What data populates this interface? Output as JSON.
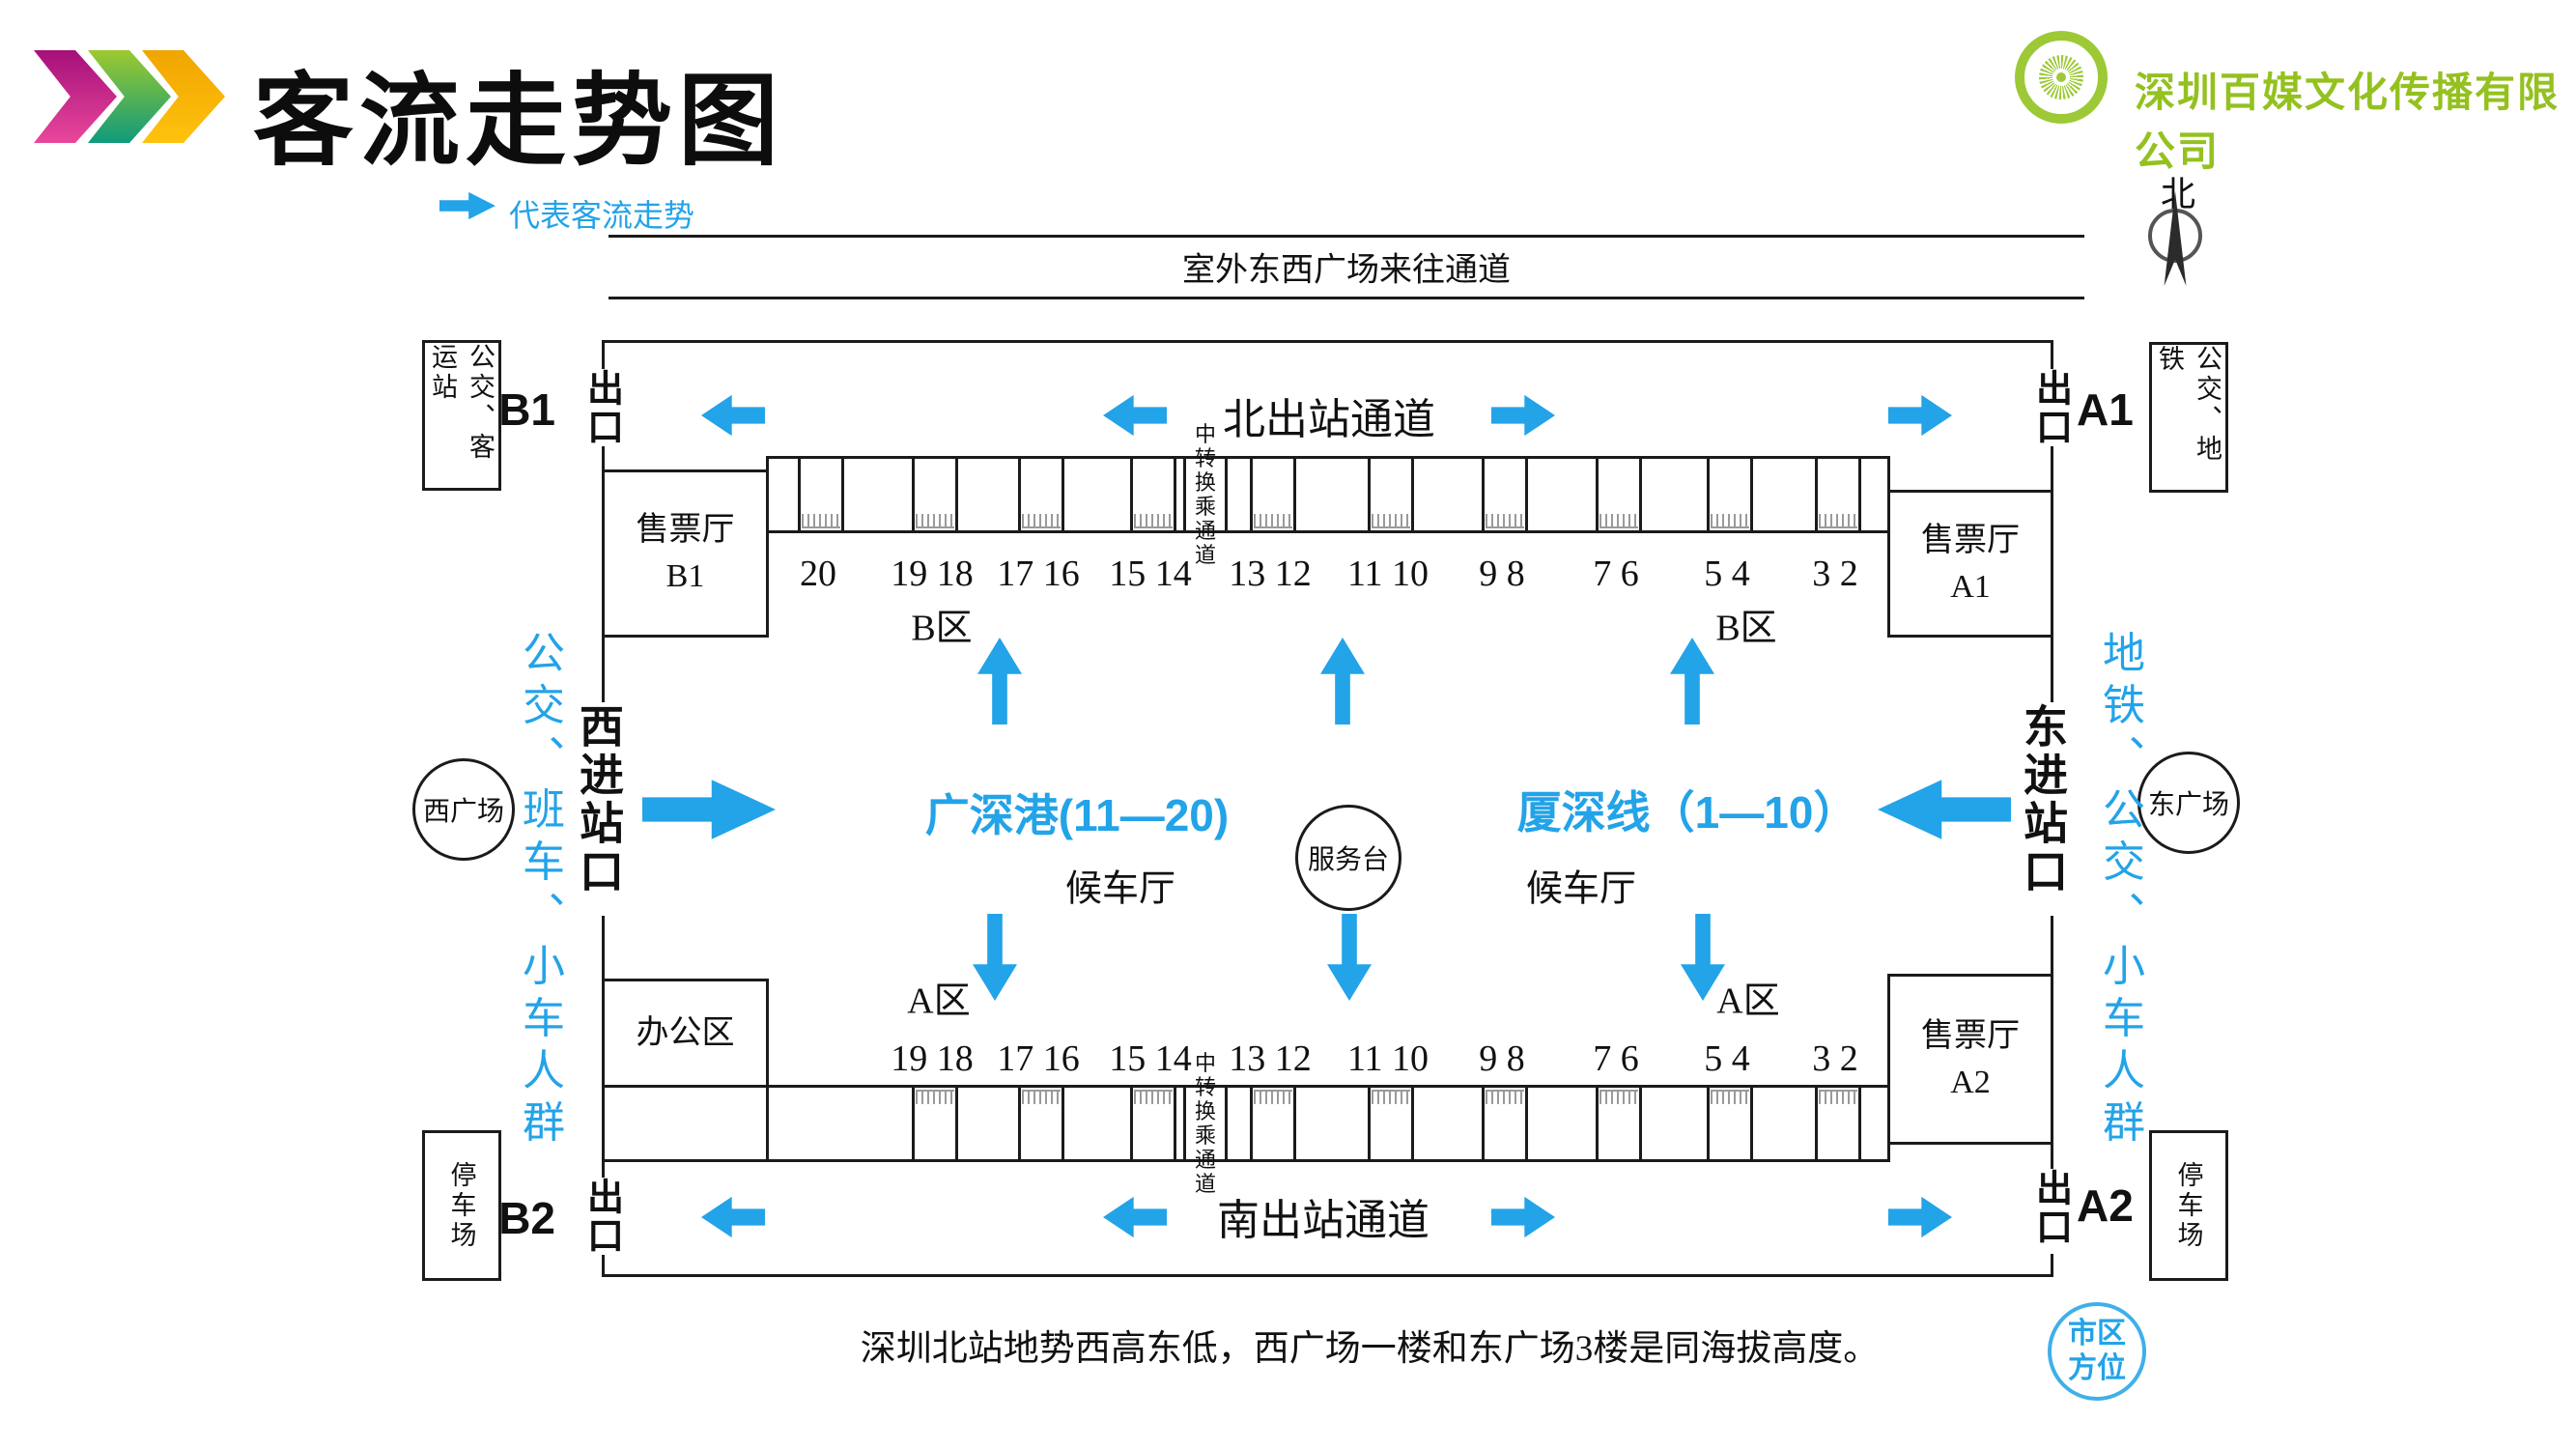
{
  "header": {
    "title": "客流走势图",
    "company": "深圳百媒文化传播有限公司"
  },
  "legend": {
    "label": "代表客流走势"
  },
  "compass": {
    "label": "北"
  },
  "corridors": {
    "outside": "室外东西广场来往通道",
    "north": "北出站通道",
    "south": "南出站通道"
  },
  "exits": {
    "exit_word": "出口",
    "b1": "B1",
    "a1": "A1",
    "b2": "B2",
    "a2": "A2"
  },
  "gates": {
    "west": "西进站口",
    "east": "东进站口"
  },
  "flow_labels": {
    "west": "公交、班车、小车人群",
    "east": "地铁、公交、小车人群"
  },
  "side_boxes": {
    "top_left": "公交、客运站",
    "top_right": "公交、地铁",
    "bottom_left": "停车场",
    "bottom_right": "停车场"
  },
  "plazas": {
    "west": "西广场",
    "east": "东广场"
  },
  "city_badge": {
    "line1": "市区",
    "line2": "方位"
  },
  "rooms": {
    "ticket_hall": "售票厅",
    "ticket_b1": "B1",
    "ticket_a1": "A1",
    "ticket_a2": "A2",
    "office": "办公区"
  },
  "hall": {
    "service_desk": "服务台",
    "west_line": "广深港(11—20)",
    "east_line": "厦深线（1—10）",
    "waiting_hall": "候车厅",
    "zone_b": "B区",
    "zone_a": "A区",
    "transfer": "中转换乘通道"
  },
  "platforms": {
    "top": [
      "20",
      "19 18",
      "17 16",
      "15 14",
      "13 12",
      "11 10",
      "9 8",
      "7 6",
      "5 4",
      "3 2"
    ],
    "bottom": [
      "19 18",
      "17 16",
      "15 14",
      "13 12",
      "11 10",
      "9 8",
      "7 6",
      "5 4",
      "3 2"
    ]
  },
  "note": "深圳北站地势西高东低，西广场一楼和东广场3楼是同海拔高度。",
  "colors": {
    "accent_blue": "#23A3E8",
    "brand_green": "#94C11F"
  }
}
